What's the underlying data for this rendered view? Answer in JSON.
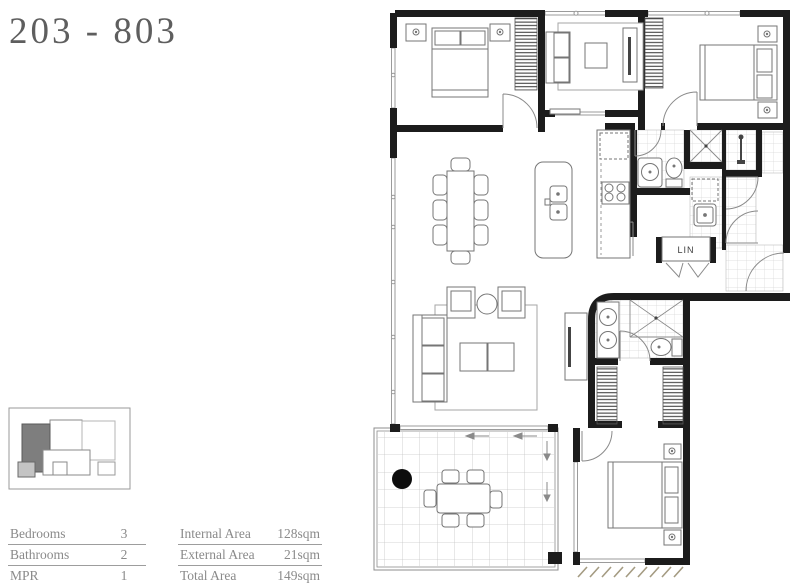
{
  "title": "203 - 803",
  "stats": {
    "left": [
      {
        "label": "Bedrooms",
        "value": "3"
      },
      {
        "label": "Bathrooms",
        "value": "2"
      },
      {
        "label": "MPR",
        "value": "1"
      }
    ],
    "right": [
      {
        "label": "Internal Area",
        "value": "128sqm"
      },
      {
        "label": "External Area",
        "value": "21sqm"
      },
      {
        "label": "Total Area",
        "value": "149sqm"
      }
    ]
  },
  "plan": {
    "linen_label": "LIN"
  },
  "colors": {
    "wall": "#1c1c1c",
    "furniture_line": "#767676",
    "window_line": "#9b9b9b",
    "tile_line": "#d8d8d8",
    "balcony_tile_line": "#c6c6c6",
    "ground_hatch": "#a49b82",
    "text_gray": "#8a8a8a",
    "title_gray": "#5e5e5e",
    "keyplan_highlight": "#7e7e7e",
    "keyplan_secondary": "#c4c4c4"
  }
}
